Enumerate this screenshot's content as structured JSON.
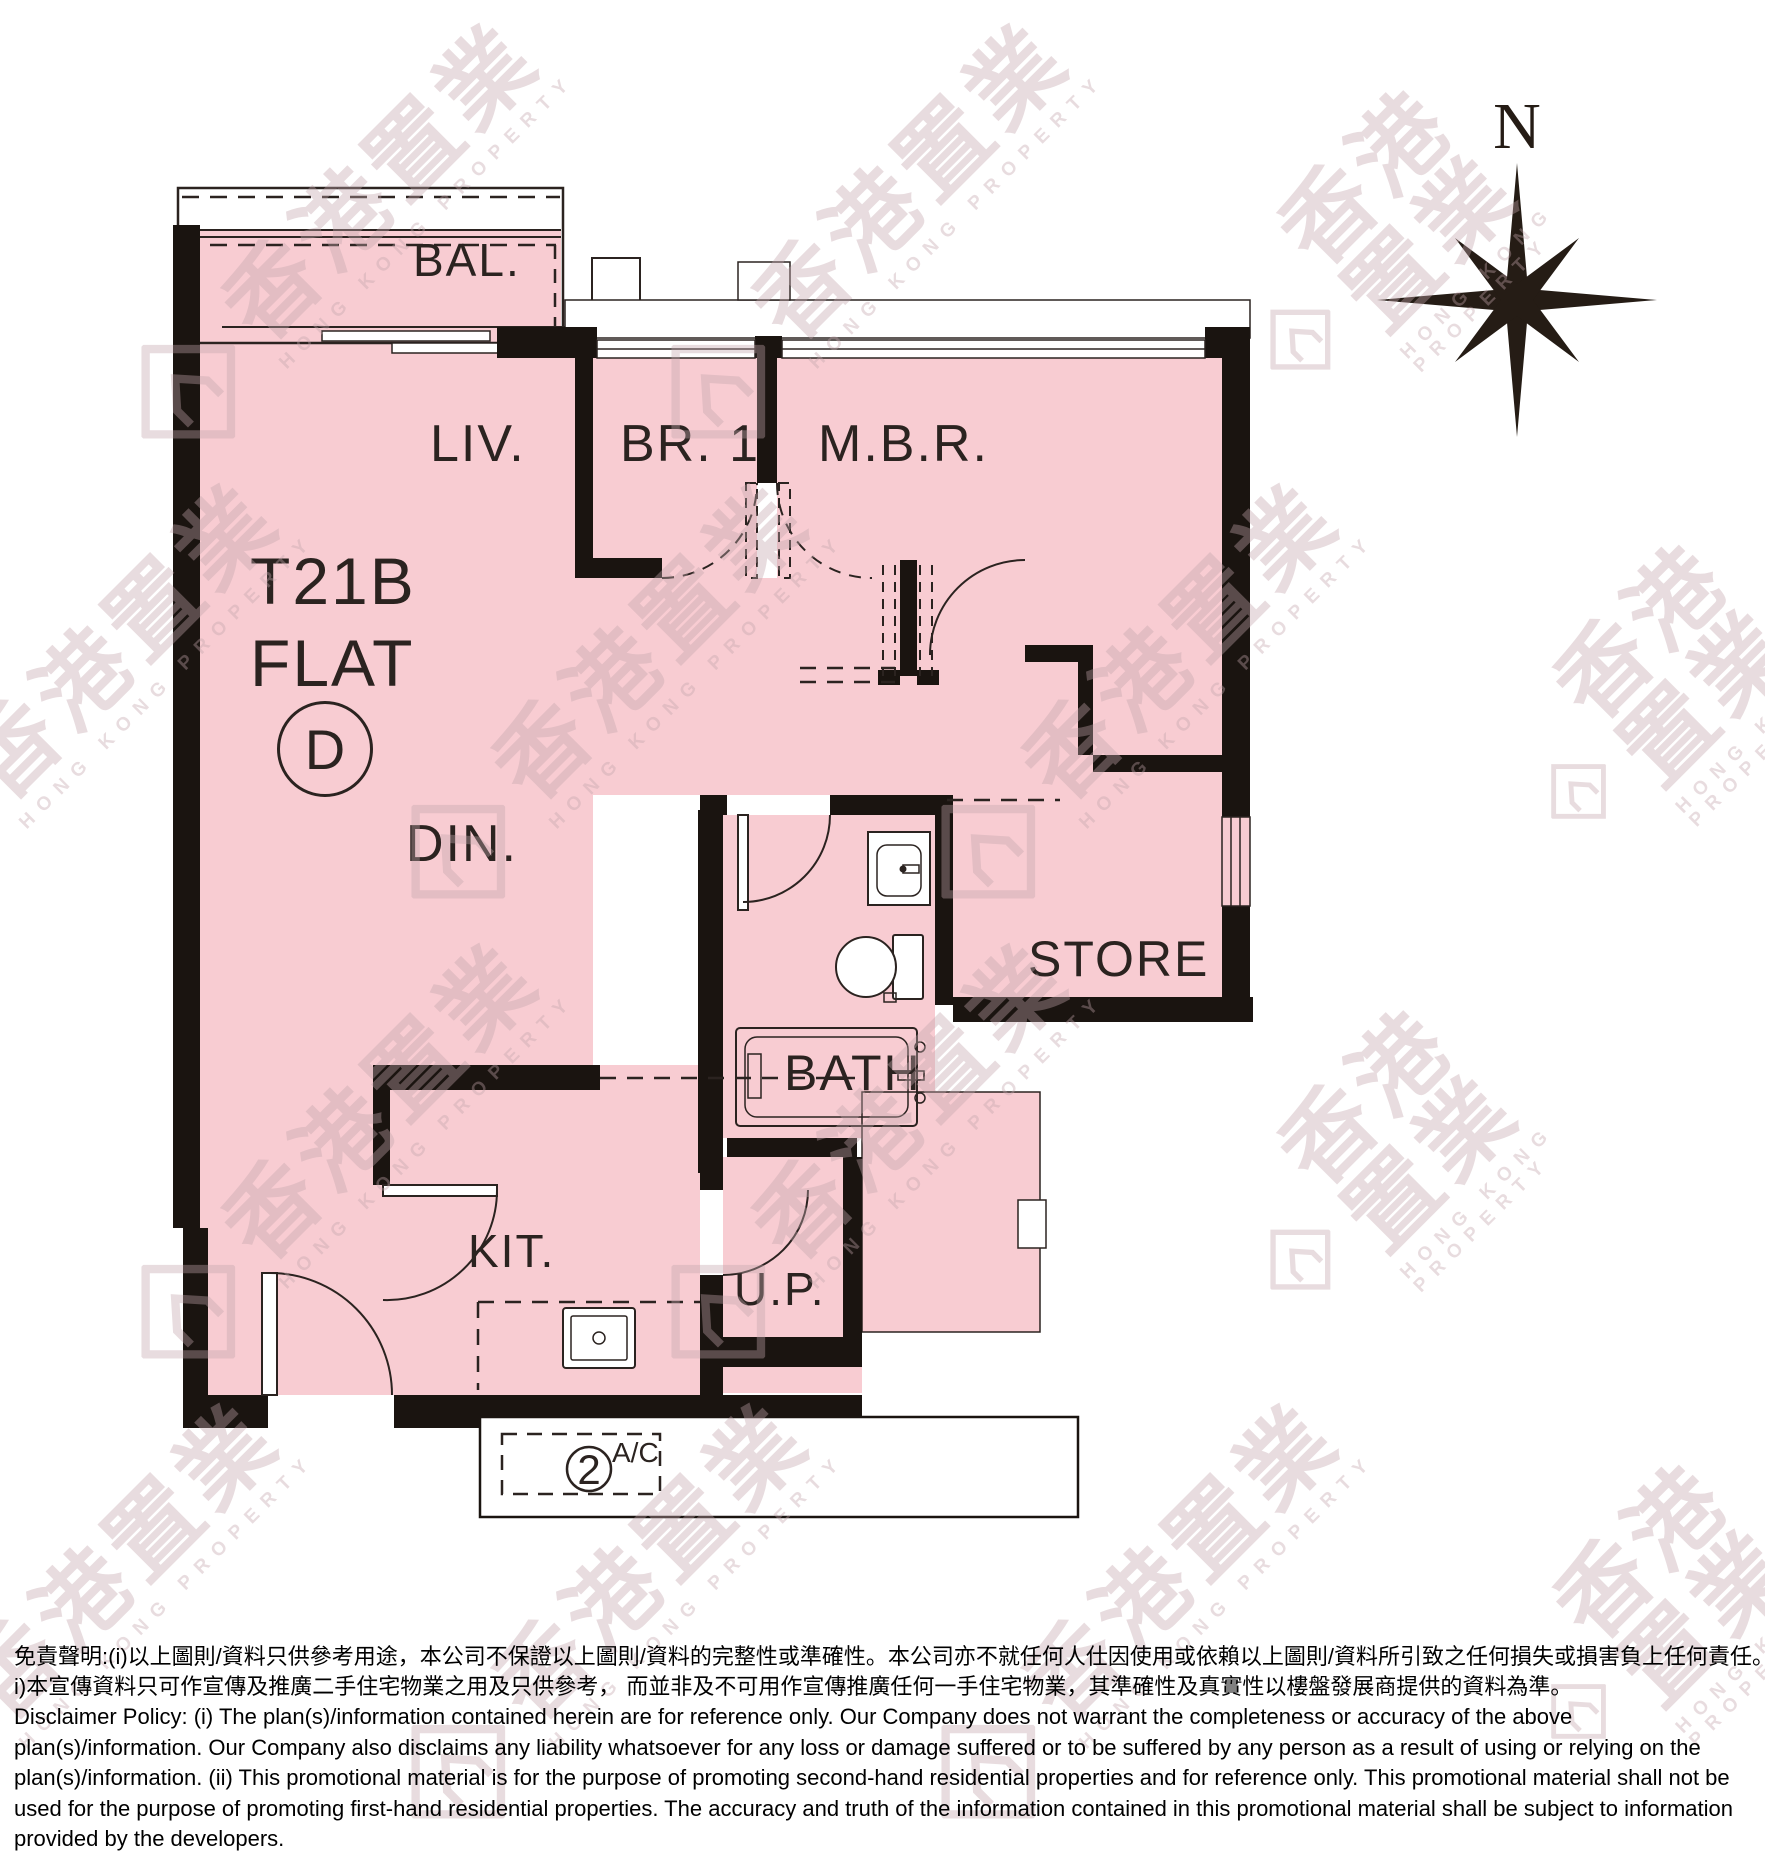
{
  "compass": {
    "label": "N"
  },
  "flat": {
    "tower": "T21B",
    "flat_word": "FLAT",
    "unit": "D"
  },
  "rooms": {
    "balcony": "BAL.",
    "living": "LIV.",
    "bedroom1": "BR. 1",
    "master_bedroom": "M.B.R.",
    "dining": "DIN.",
    "store": "STORE",
    "bath": "BATH",
    "kitchen": "KIT.",
    "utility_platform": "U.P."
  },
  "ac": {
    "number": "2",
    "label": "A/C"
  },
  "watermark": {
    "cn": "香港置業",
    "en": "HONG KONG PROPERTY"
  },
  "disclaimer": {
    "zh_line1": "免責聲明:(i)以上圖則/資料只供參考用途，本公司不保證以上圖則/資料的完整性或準確性。本公司亦不就任何人仕因使用或依賴以上圖則/資料所引致之任何損失或損害負上任何責任。(i",
    "zh_line2": "i)本宣傳資料只可作宣傳及推廣二手住宅物業之用及只供參考， 而並非及不可用作宣傳推廣任何一手住宅物業，其準確性及真實性以樓盤發展商提供的資料為準。",
    "en": "Disclaimer Policy: (i) The plan(s)/information contained herein are for reference only. Our Company does not warrant the completeness or accuracy of the above plan(s)/information. Our Company also disclaims any liability whatsoever for any loss or damage suffered or to be suffered by any person as a result of using or relying on the plan(s)/information. (ii) This promotional material is for the purpose of promoting second-hand residential properties and for reference only. This promotional material shall not be used for the purpose of promoting first-hand residential properties. The accuracy and truth of the information contained in this promotional material shall be subject to information provided by the developers."
  },
  "colors": {
    "room_fill": "#f8ccd2",
    "wall": "#1a1410",
    "line": "#2b2320",
    "watermark": "#c3a6ac"
  }
}
